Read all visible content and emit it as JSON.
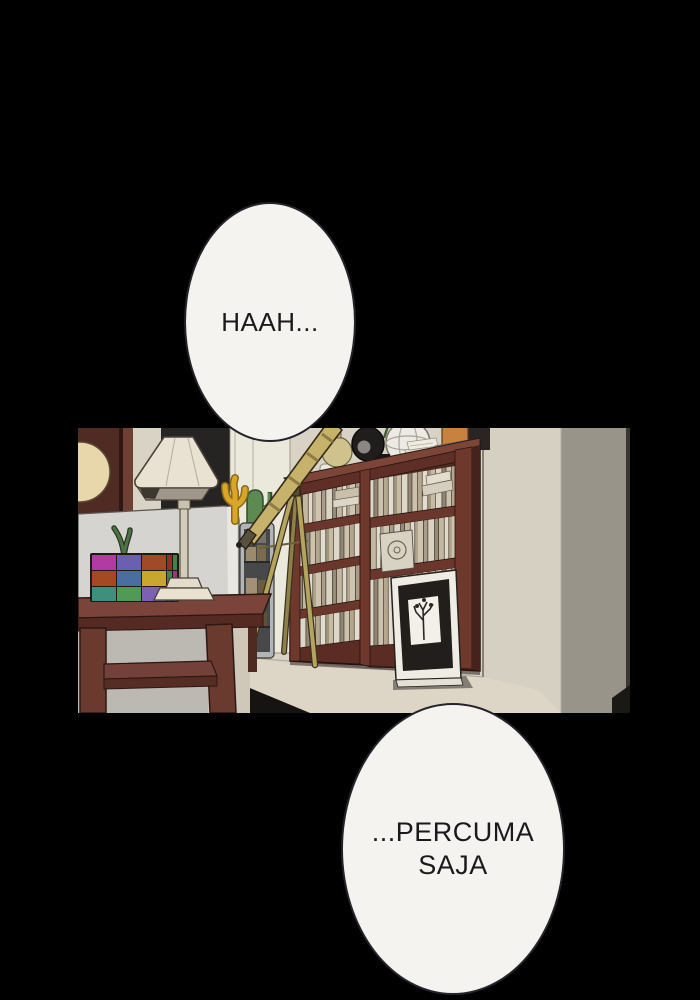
{
  "speech": {
    "bubble1": {
      "text": "HAAH..."
    },
    "bubble2": {
      "line1": "...PERCUMA",
      "line2": "SAJA"
    }
  },
  "panel": {
    "kind": "comic-interior-scene",
    "objects": [
      "dark-wood-door",
      "round-wall-mirror",
      "dark-window",
      "white-door",
      "floor-lamp",
      "sofa",
      "coral-decoration",
      "cactus-plant",
      "storage-cabinet",
      "telescope",
      "tripod",
      "bookshelf",
      "books",
      "wire-globe",
      "camera-lens",
      "glass-ball",
      "paper-stack",
      "orange-box",
      "picture-frame-with-tree",
      "side-table",
      "rubiks-cube",
      "table-plant",
      "floor",
      "wall-corner"
    ],
    "palette": {
      "page_background": "#000000",
      "wall_beige": "#d8d3c5",
      "wall_gray": "#99948a",
      "bookshelf_wood": "#5e2f27",
      "table_wood": "#6b3a2f",
      "telescope_brass": "#c6b26a",
      "sofa_gray": "#d5d4d0",
      "bubble_fill": "#f4f3f0",
      "bubble_outline": "#25232a",
      "text_color": "#1a1a1a"
    }
  }
}
